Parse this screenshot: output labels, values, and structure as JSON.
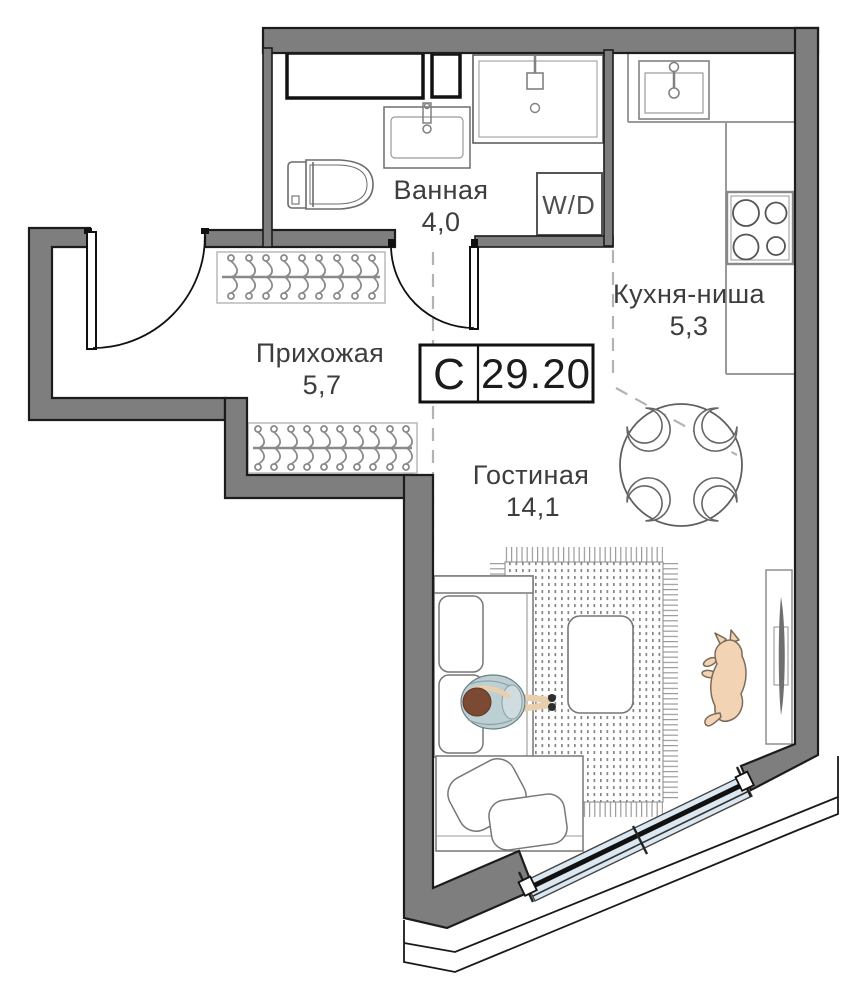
{
  "plan": {
    "unit": {
      "type_label": "С",
      "total_area": "29.20"
    },
    "rooms": [
      {
        "name": "Ванная",
        "area": "4,0"
      },
      {
        "name": "Прихожая",
        "area": "5,7"
      },
      {
        "name": "Кухня-ниша",
        "area": "5,3"
      },
      {
        "name": "Гостиная",
        "area": "14,1"
      }
    ],
    "appliances": {
      "washer_dryer_label": "W/D"
    },
    "colors": {
      "wall_fill": "#7e7e7e",
      "wall_outline": "#1c1c1c",
      "window_glass": "#dbe8f1",
      "text": "#3d3d3d"
    }
  }
}
